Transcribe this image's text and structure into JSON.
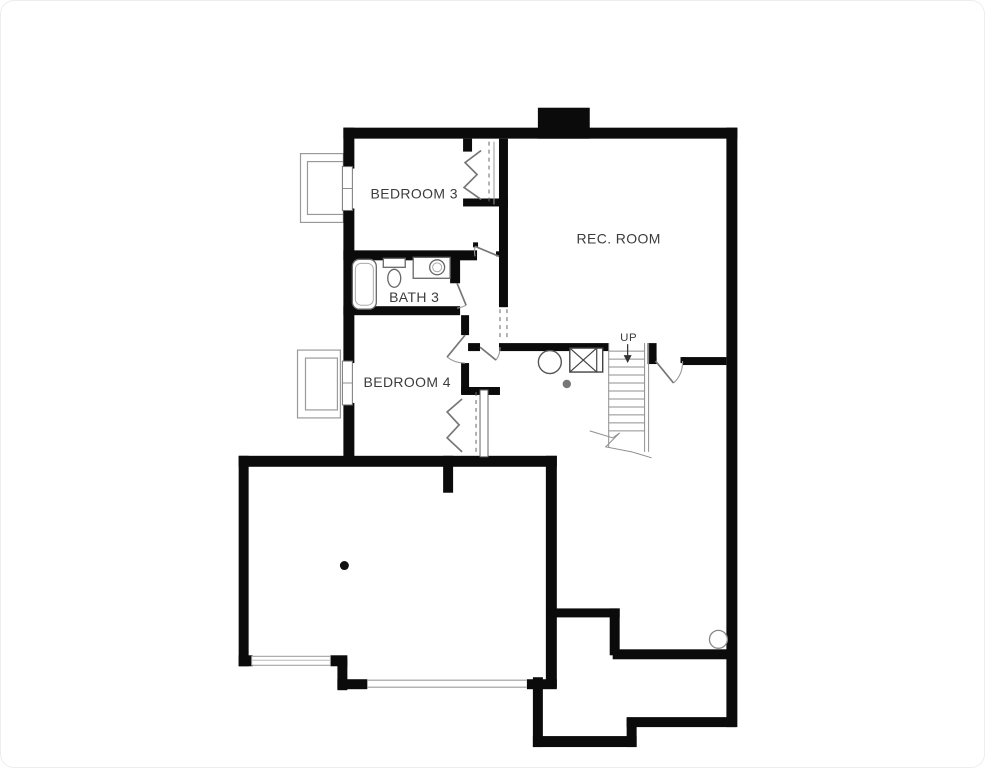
{
  "page": {
    "background": "#ffffff",
    "border_color": "#ededed"
  },
  "plan": {
    "type": "basement-floor-plan",
    "wall_color": "#0b0b0b",
    "thin_line_color": "#8f8f8f",
    "text_color": "#3c3c3c",
    "rooms": [
      {
        "id": "bedroom-3",
        "label": "BEDROOM 3"
      },
      {
        "id": "rec-room",
        "label": "REC. ROOM"
      },
      {
        "id": "bath-3",
        "label": "BATH 3"
      },
      {
        "id": "bedroom-4",
        "label": "BEDROOM 4"
      }
    ],
    "stairs": {
      "label": "UP",
      "direction": "up"
    },
    "fixtures": [
      "bathtub",
      "toilet",
      "vanity-sink",
      "furnace",
      "sump-pump",
      "floor-drain",
      "support-column",
      "window-well-bedroom-3",
      "window-well-bedroom-4",
      "basement-window",
      "garage-door-opening",
      "sump-pit",
      "stairs",
      "chimney",
      "closet-bifold-doors"
    ]
  }
}
